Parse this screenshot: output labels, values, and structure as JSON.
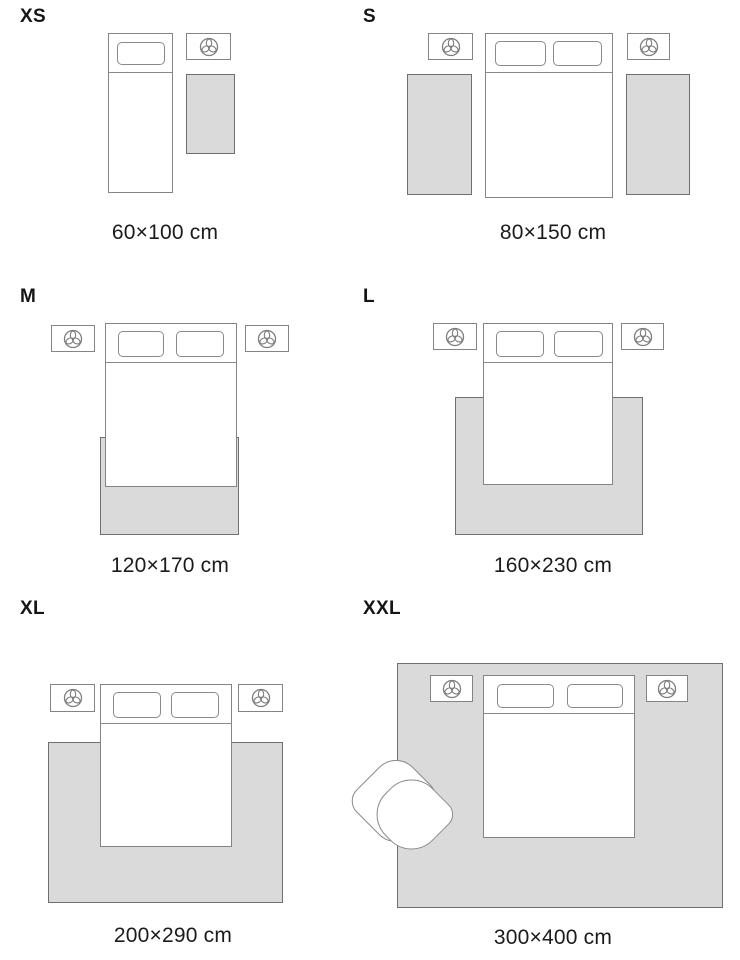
{
  "page": {
    "title": "Rug size guide"
  },
  "colors": {
    "background": "#ffffff",
    "rug_fill": "#dadada",
    "rug_border": "#6f6f6f",
    "furniture_border": "#848484",
    "text": "#1b1b1b"
  },
  "icons": {
    "nightstand": "plant-top-view-icon"
  },
  "panels": [
    {
      "size": "XS",
      "dimensions": "60×100 cm"
    },
    {
      "size": "S",
      "dimensions": "80×150 cm"
    },
    {
      "size": "M",
      "dimensions": "120×170 cm"
    },
    {
      "size": "L",
      "dimensions": "160×230 cm"
    },
    {
      "size": "XL",
      "dimensions": "200×290 cm"
    },
    {
      "size": "XXL",
      "dimensions": "300×400 cm"
    }
  ]
}
